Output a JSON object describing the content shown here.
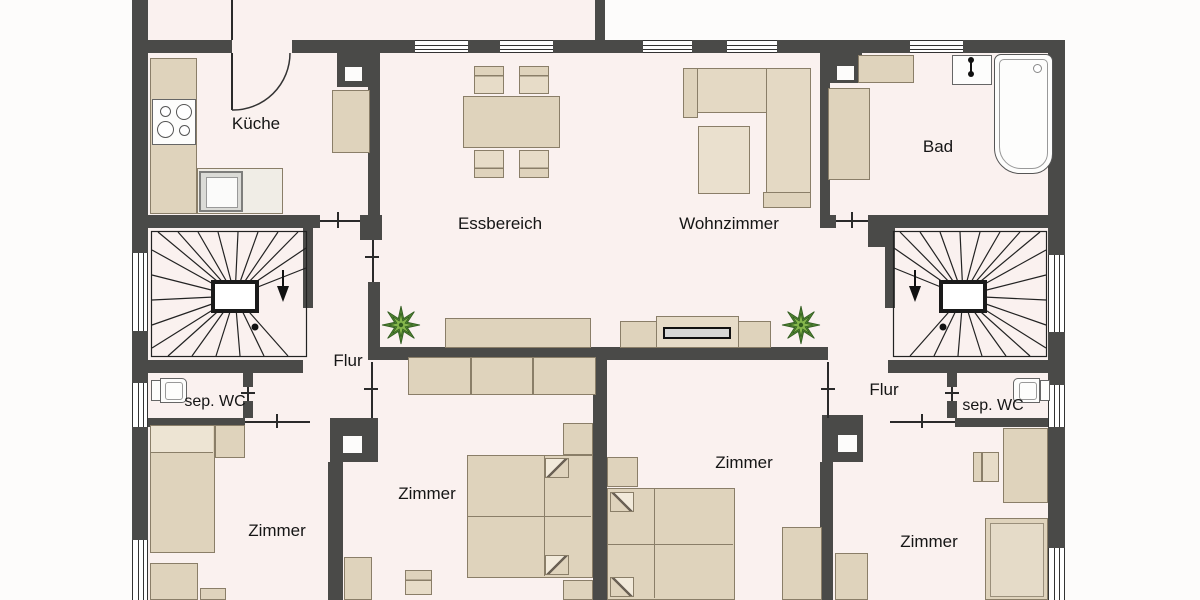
{
  "floorplan": {
    "title": "Apartment floor plan",
    "rooms": {
      "kueche": {
        "label": "Küche"
      },
      "essbereich": {
        "label": "Essbereich"
      },
      "wohnzimmer": {
        "label": "Wohnzimmer"
      },
      "bad": {
        "label": "Bad"
      },
      "flur_left": {
        "label": "Flur"
      },
      "wc_left": {
        "label": "sep. WC"
      },
      "zimmer_bottom_left": {
        "label": "Zimmer"
      },
      "zimmer_mid_left": {
        "label": "Zimmer"
      },
      "zimmer_mid_right": {
        "label": "Zimmer"
      },
      "flur_right": {
        "label": "Flur"
      },
      "wc_right": {
        "label": "sep. WC"
      },
      "zimmer_bottom_right": {
        "label": "Zimmer"
      }
    },
    "colors": {
      "wall": "#4A4A48",
      "floor": "#FAF1EF",
      "furniture": "#DFD3BC",
      "furniture_border": "#8A7E68",
      "plant_dark": "#4F8230",
      "plant_light": "#85B64C"
    }
  }
}
